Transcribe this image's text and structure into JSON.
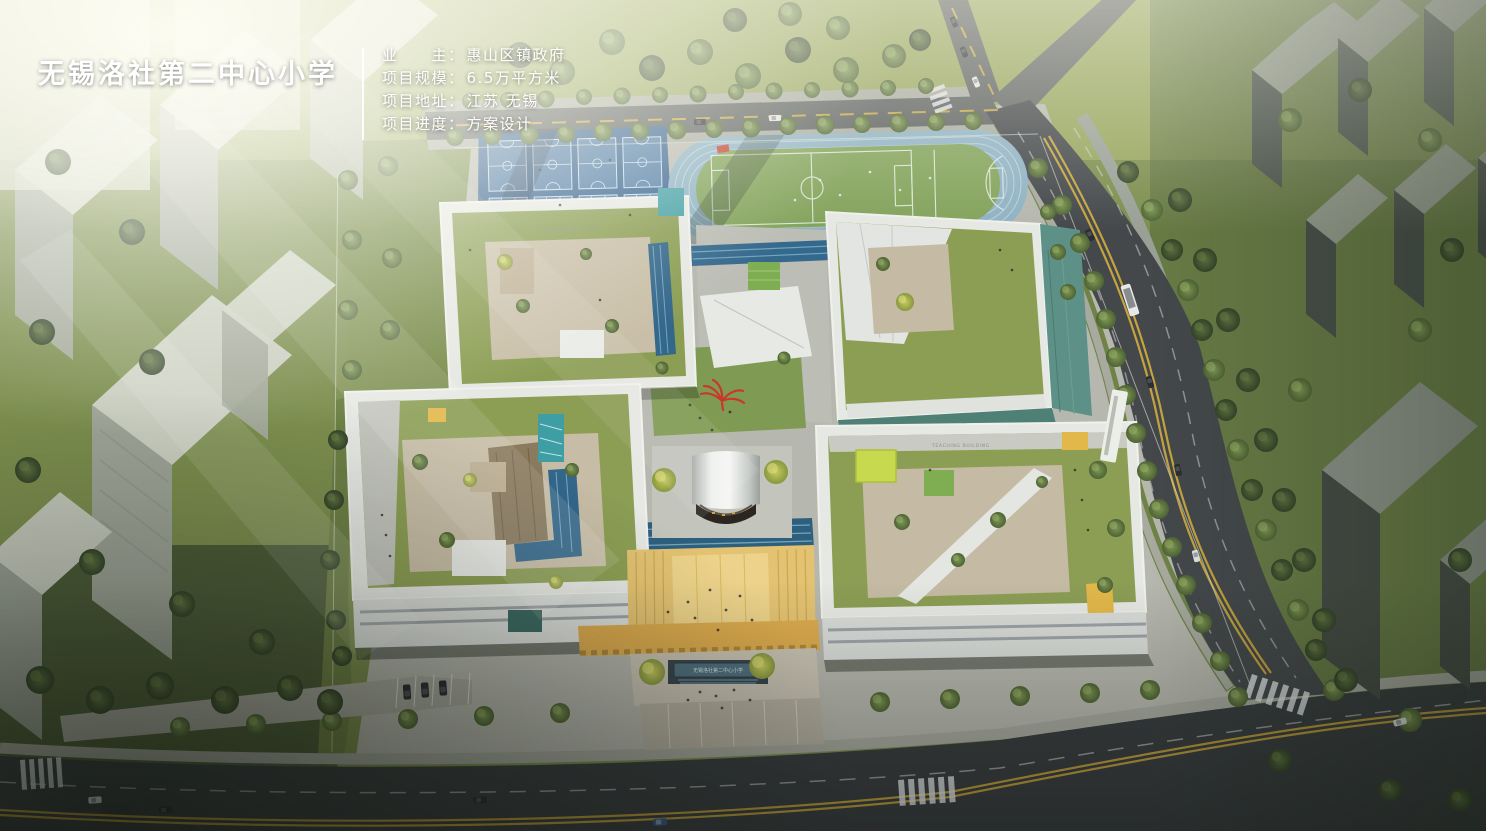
{
  "project_card": {
    "title": "无锡洛社第二中心小学",
    "fields": [
      {
        "label": "业　　主：",
        "value": "惠山区镇政府"
      },
      {
        "label": "项目规模：",
        "value": "6.5万平方米"
      },
      {
        "label": "项目地址：",
        "value": "江苏 无锡"
      },
      {
        "label": "项目进度：",
        "value": "方案设计"
      }
    ]
  },
  "scene": {
    "labels": {
      "teaching_building_north": "TEACHING BUILDING",
      "teaching_building_south": "TEACHING BUILDING",
      "entrance_plaque": "无锡洛社第二中心小学"
    },
    "palette": {
      "track_lane_blue": "#8fb2c4",
      "court_blue": "#3f6b9b",
      "field_green": "#83a35b",
      "roof_green": "#8c9e54",
      "facade_teal": "#5d9187",
      "stair_teal": "#41a2a8",
      "accent_lime": "#c6d94f",
      "accent_yellow": "#e2b84a",
      "plaza_yellow": "#e3c272",
      "sculpture_red": "#c9392b",
      "road_asphalt": "#3f4347",
      "lane_yellow": "#d4ae3e"
    }
  }
}
